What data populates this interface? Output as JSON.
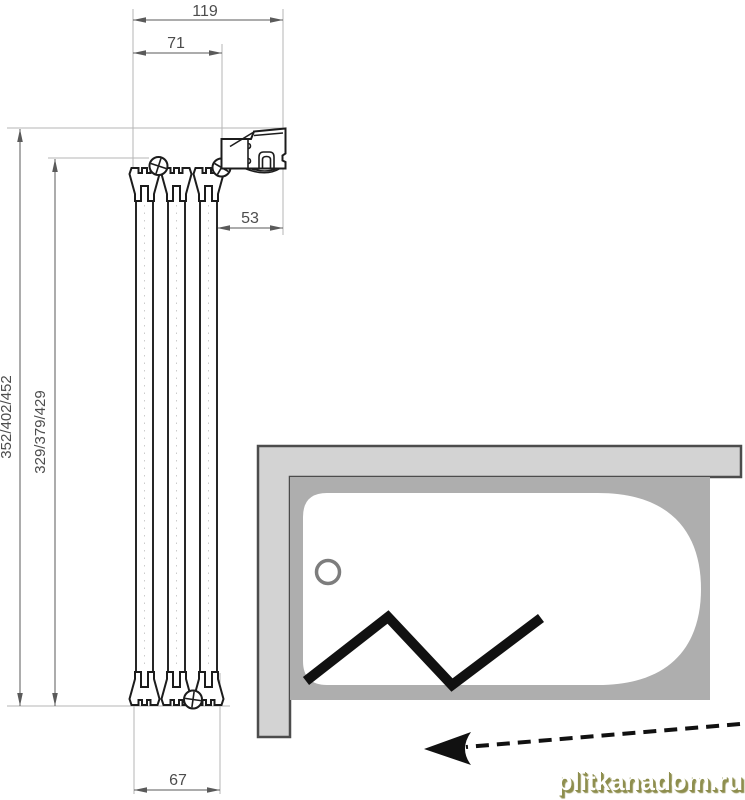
{
  "diagram": {
    "title": "folding-bath-screen-installation-drawing",
    "dimensions": {
      "top_total_width": "119",
      "top_inner_width": "71",
      "wall_profile_offset": "53",
      "bottom_stack_width": "67",
      "height_outer": "352/402/452",
      "height_inner": "329/379/429"
    },
    "watermark": "plitkanadom.ru",
    "colors": {
      "profile_line": "#1c1c1c",
      "dimension_line": "#5a5a5a",
      "dimension_text": "#4d4d4d",
      "extension_line": "#b5b5b5",
      "wall_fill": "#d3d3d3",
      "wall_stroke": "#4c4c4c",
      "tub_rim_fill": "#aeaeae",
      "tub_fill": "#ffffff",
      "screen_zigzag": "#111111",
      "watermark_face": "#ffffff",
      "watermark_shadow": "#8e8e4e"
    }
  }
}
